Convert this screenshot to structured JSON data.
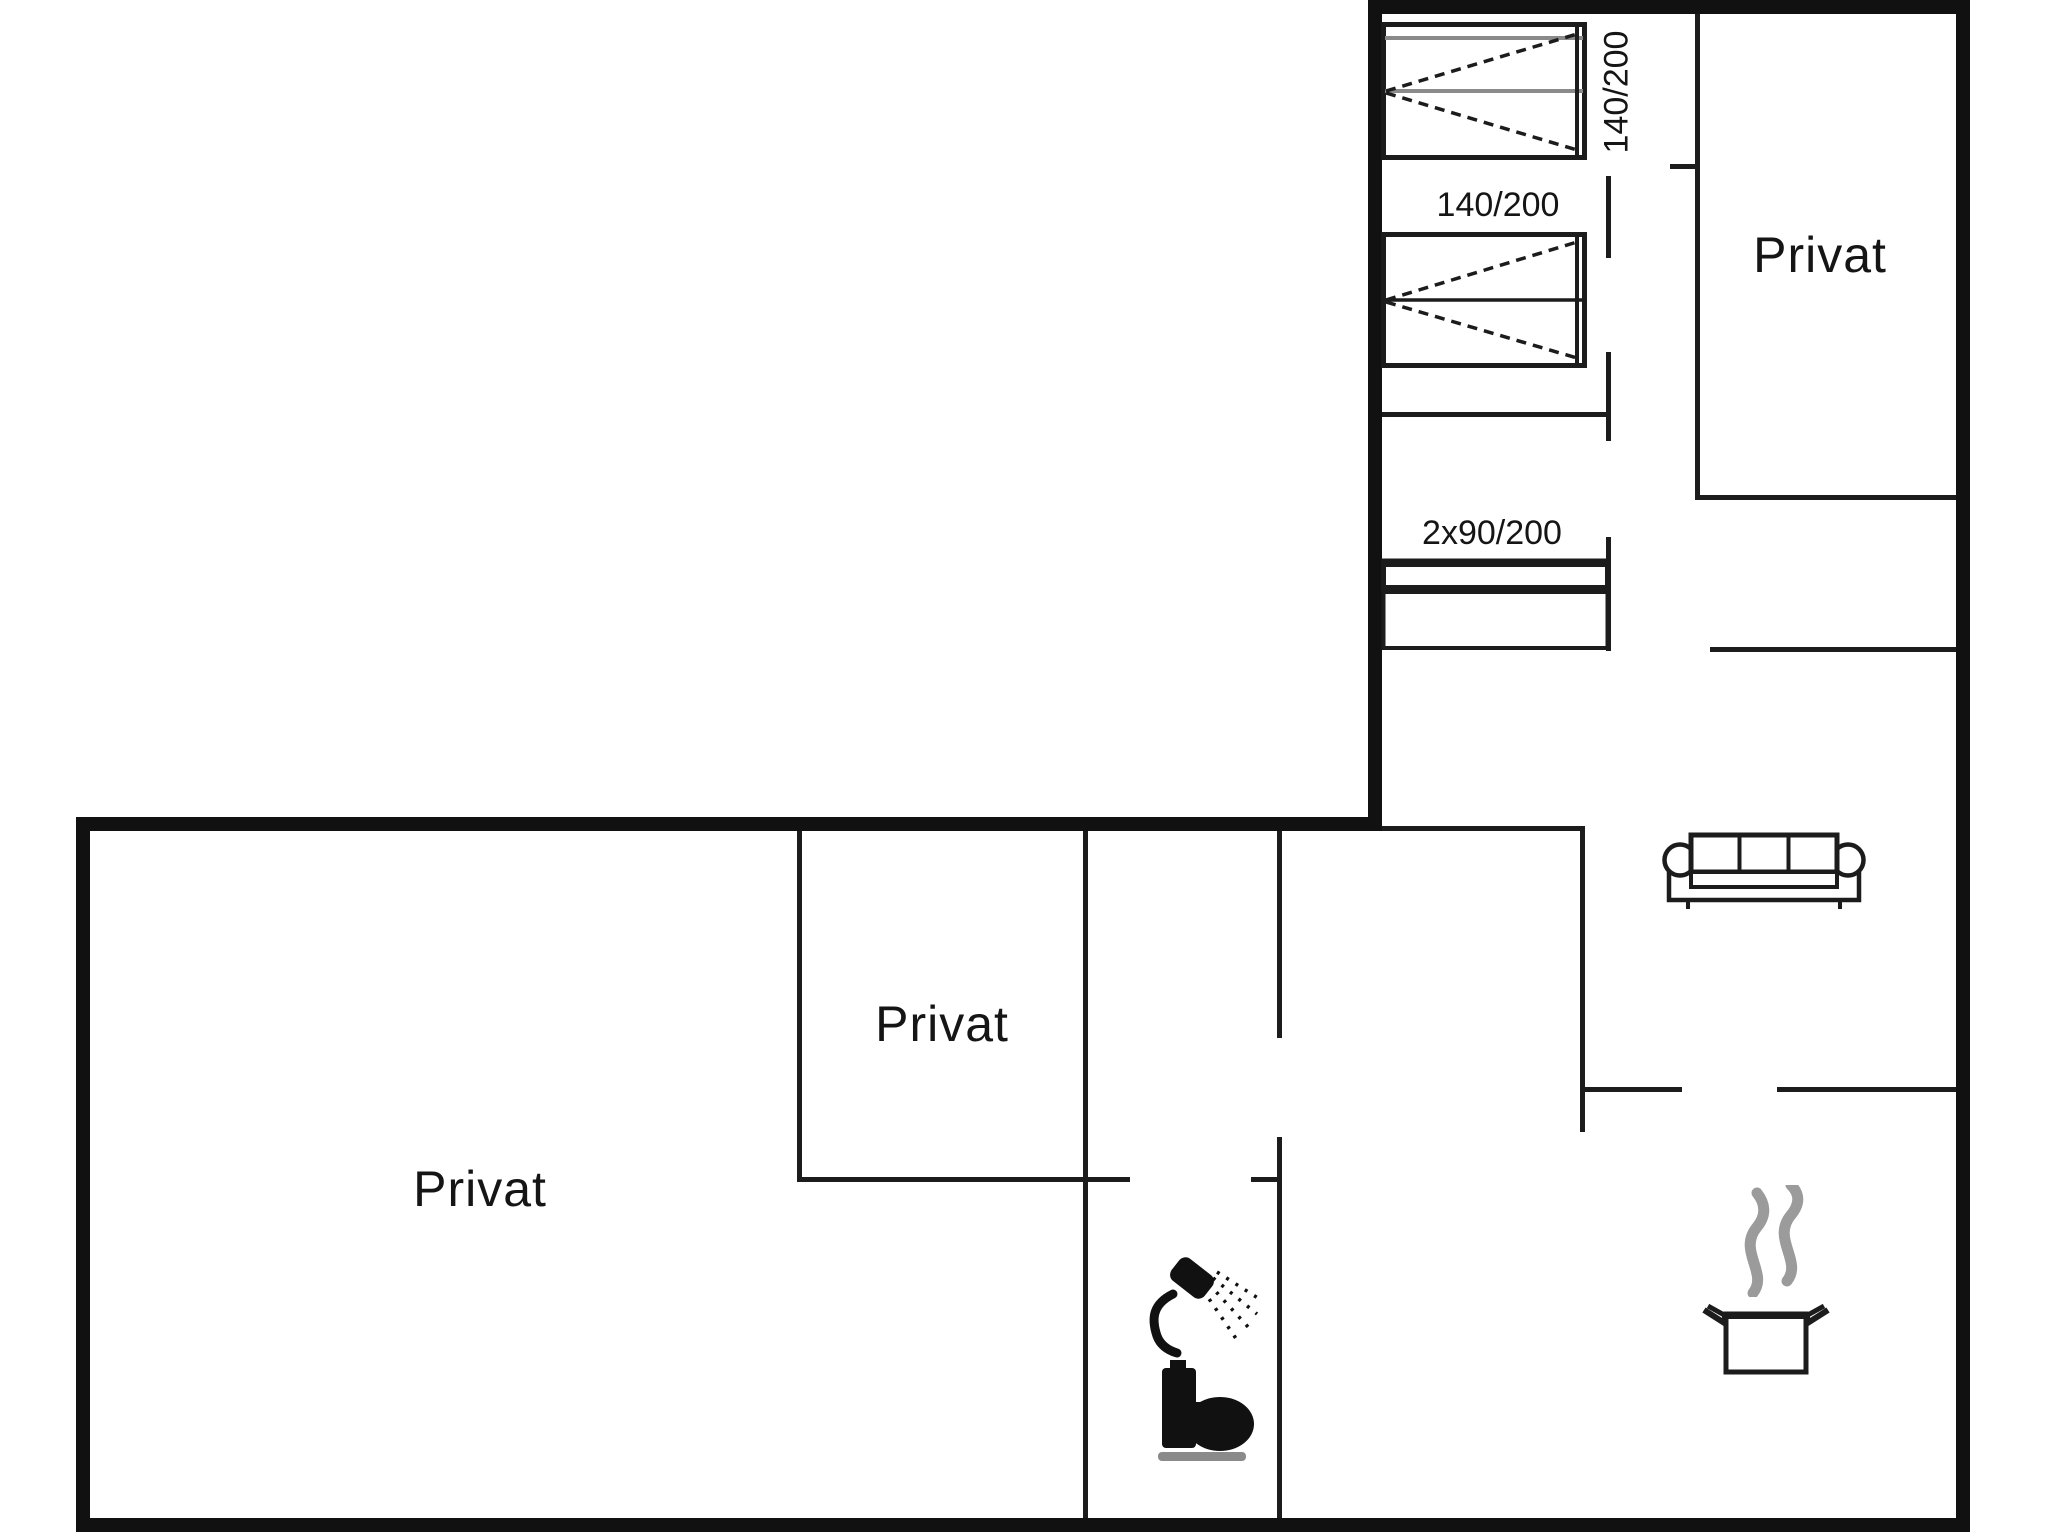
{
  "title": "Holiday house floor plan",
  "colors": {
    "background": "#ffffff",
    "wall": "#1c1c1c",
    "furniture_line": "#1c1c1c",
    "steam": "#9b9b9b",
    "toilet_base": "#8a8a8a"
  },
  "rooms": [
    {
      "id": "privat-upper-right",
      "label": "Privat"
    },
    {
      "id": "privat-middle",
      "label": "Privat"
    },
    {
      "id": "privat-large",
      "label": "Privat"
    }
  ],
  "furniture": {
    "bed_top_label": "140/200",
    "bed_middle_label": "140/200",
    "bunk_label": "2x90/200"
  },
  "icons": [
    "double-bed-icon",
    "double-bed-icon",
    "bunk-bed-icon",
    "sofa-icon",
    "shower-icon",
    "toilet-icon",
    "cooking-pot-icon",
    "steam-icon"
  ]
}
